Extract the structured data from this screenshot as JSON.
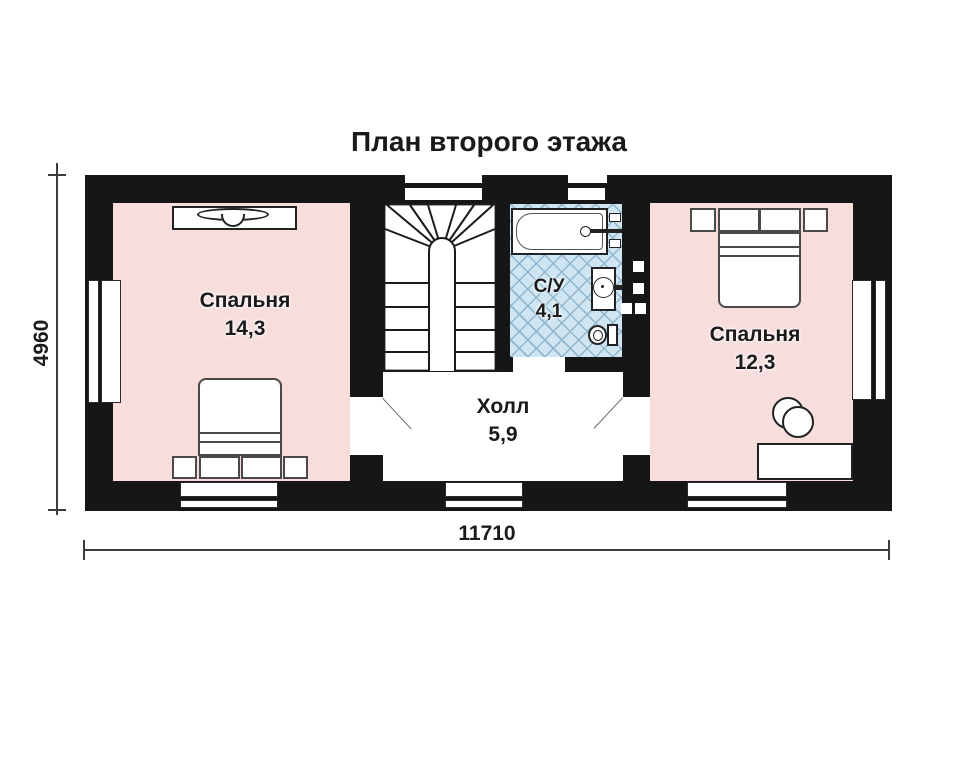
{
  "title": "План второго этажа",
  "rooms": {
    "bedroom_left": {
      "name": "Спальня",
      "area": "14,3"
    },
    "hall": {
      "name": "Холл",
      "area": "5,9"
    },
    "bathroom": {
      "name": "С/У",
      "area": "4,1"
    },
    "bedroom_right": {
      "name": "Спальня",
      "area": "12,3"
    }
  },
  "dimensions": {
    "overall_width": "11710",
    "overall_height": "4960"
  },
  "colors": {
    "paper": "#ffffff",
    "wall": "#161616",
    "line": "#1a1a1a",
    "bedroom_fill": "#f7dedd",
    "bathroom_fill": "#cfe5f1",
    "bathroom_grid": "#8fb6ce"
  }
}
